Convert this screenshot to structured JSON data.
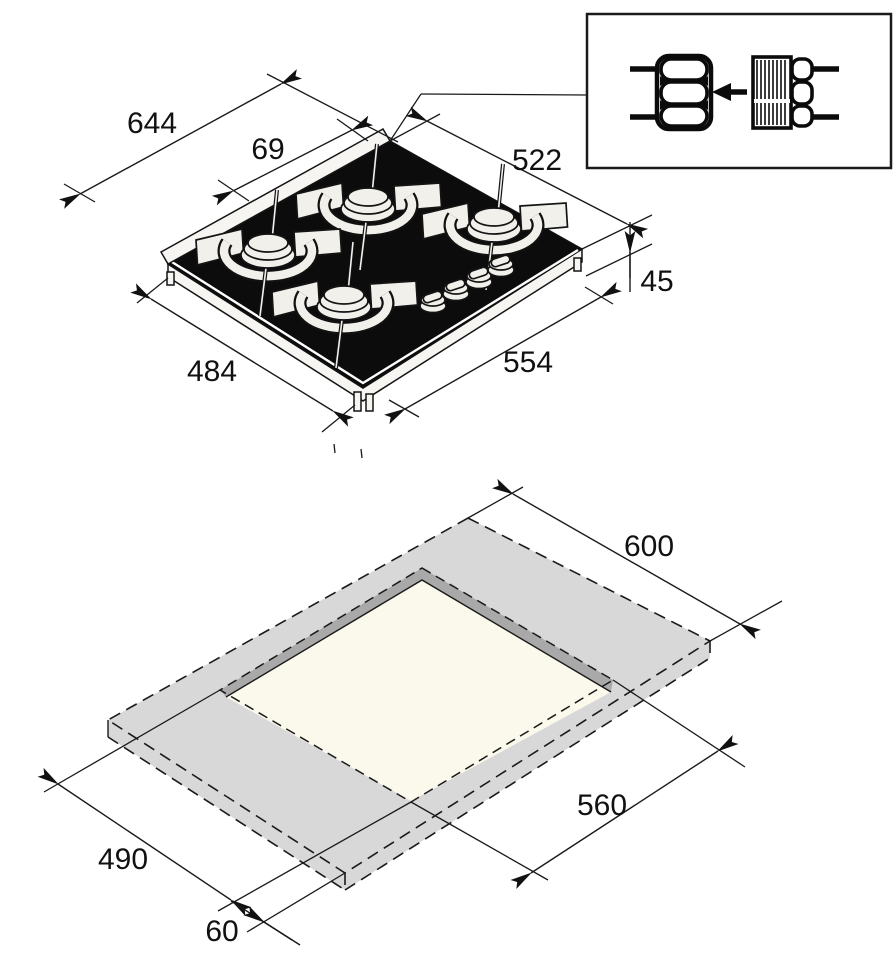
{
  "hob_view": {
    "dim_overall_width": "644",
    "dim_connection_offset": "69",
    "dim_width": "522",
    "dim_height": "45",
    "dim_depth_right": "554",
    "dim_depth_left": "484"
  },
  "cutout_view": {
    "dim_worktop_width": "600",
    "dim_cutout_width": "560",
    "dim_cutout_depth": "490",
    "dim_front_clearance": "60"
  },
  "inset": {
    "icon": "gas-connection-fitting",
    "arrow_direction": "left"
  },
  "colors": {
    "line": "#1a1a1a",
    "glass_black": "#0c0c0c",
    "metal_light": "#f2f0ea",
    "worktop_gray": "#d8d8d8",
    "cutout_wall_gray": "#a9a9a9",
    "cutout_floor_cream": "#fbf8ec"
  }
}
